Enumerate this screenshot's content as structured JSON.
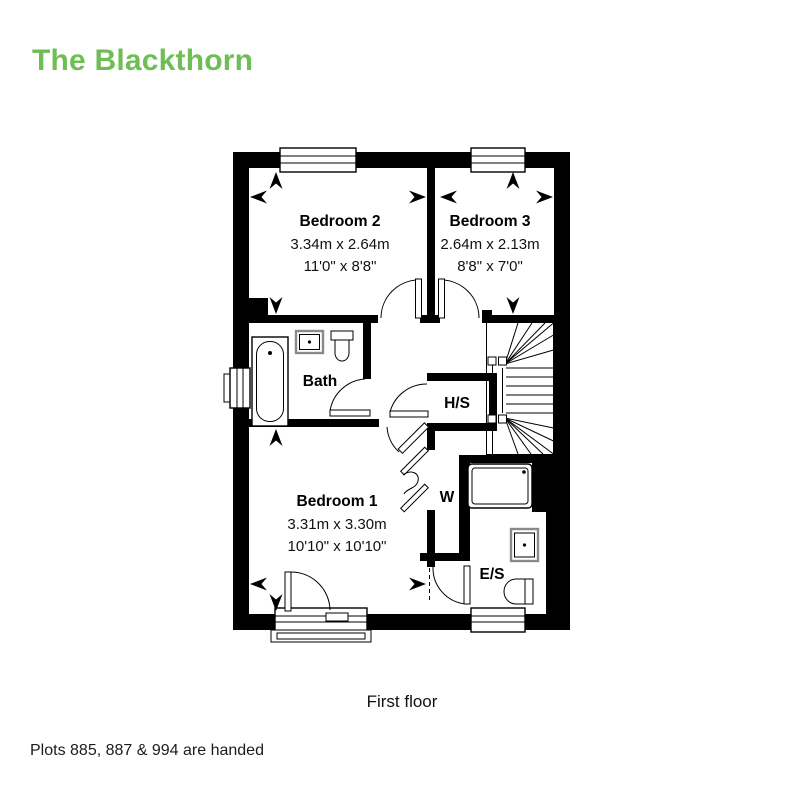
{
  "header": {
    "title": "The Blackthorn",
    "accent_color": "#6FBE55"
  },
  "plan": {
    "bedroom2": {
      "name": "Bedroom 2",
      "metric": "3.34m x 2.64m",
      "imperial": "11'0\" x 8'8\""
    },
    "bedroom3": {
      "name": "Bedroom 3",
      "metric": "2.64m x 2.13m",
      "imperial": "8'8\" x 7'0\""
    },
    "bedroom1": {
      "name": "Bedroom 1",
      "metric": "3.31m x 3.30m",
      "imperial": "10'10\" x 10'10\""
    },
    "bath": {
      "name": "Bath"
    },
    "hot_water_store": {
      "name": "H/S"
    },
    "wardrobe": {
      "name": "W"
    },
    "ensuite": {
      "name": "E/S"
    }
  },
  "footer": {
    "floor_label": "First floor",
    "handed_note": "Plots 885, 887 & 994 are handed"
  }
}
